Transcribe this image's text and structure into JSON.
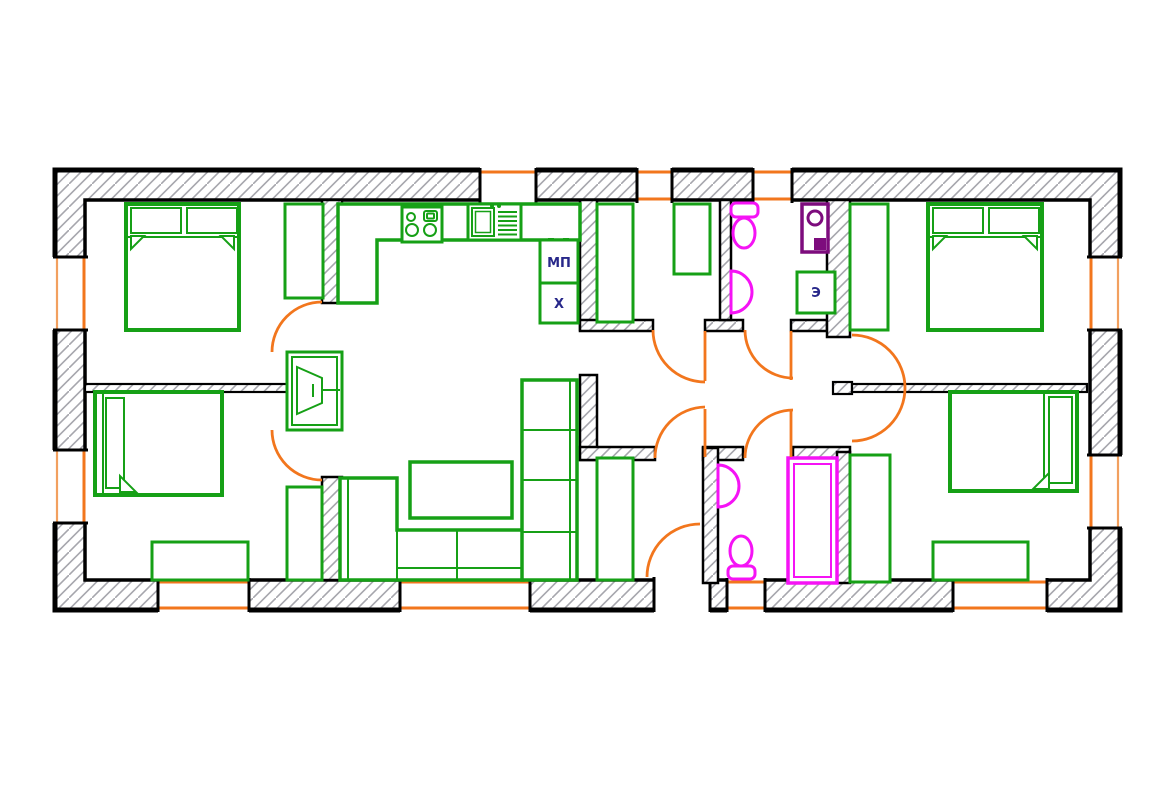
{
  "drawing": {
    "type": "architectural floor plan",
    "style": "CAD plan view, single-storey apartment / house"
  },
  "labels": {
    "dishwasher": "МП",
    "fridge": "Х",
    "electric_unit": "Э"
  },
  "colors": {
    "walls": "#000000",
    "wall_hatch": "#a6a6ad",
    "furniture": "#16a016",
    "doors_windows": "#f2761d",
    "sanitary": "#f513f5",
    "boiler": "#7d0c7d",
    "label_text": "#28288a",
    "background": "#ffffff"
  }
}
